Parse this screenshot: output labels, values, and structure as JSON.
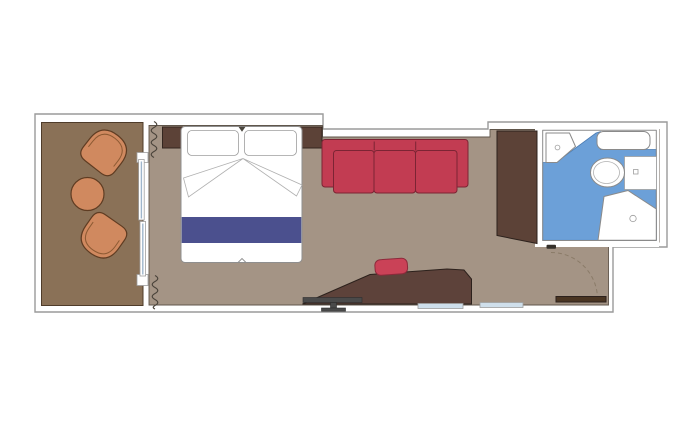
{
  "page": {
    "title": "Cruise ship cabin floor plan",
    "type": "floor-plan"
  },
  "colors": {
    "background": "#ffffff",
    "wall_fill": "#ffffff",
    "floor_cabin": "#a49485",
    "floor_balcony": "#8a7157",
    "wood_dark": "#5c4237",
    "desk_wood": "#5d423a",
    "sofa_red": "#c23c52",
    "stool_red": "#ca4257",
    "bed_white": "#ffffff",
    "runner_navy": "#4b508e",
    "chair_orange": "#d0895f",
    "chair_line": "#8d5a33",
    "bath_floor_blue": "#6ca0d8",
    "fixture_white": "#ffffff",
    "tv_gray": "#4a4a4a",
    "mirror_strip": "#cfdfeb",
    "door_wood": "#4a3522",
    "door_mark": "#35302a",
    "notch_dark": "#4a463e"
  },
  "rooms": [
    {
      "name": "balcony"
    },
    {
      "name": "sleeping-area"
    },
    {
      "name": "living-area"
    },
    {
      "name": "bathroom"
    },
    {
      "name": "entryway"
    }
  ],
  "furniture": [
    {
      "name": "balcony-armchair",
      "count": 2
    },
    {
      "name": "balcony-table",
      "count": 1
    },
    {
      "name": "double-bed",
      "pillows": 2
    },
    {
      "name": "bed-runner",
      "count": 1
    },
    {
      "name": "sofa",
      "cushions": 3
    },
    {
      "name": "wardrobe",
      "count": 1
    },
    {
      "name": "desk",
      "count": 1
    },
    {
      "name": "stool",
      "count": 1
    },
    {
      "name": "tv-stand",
      "count": 1
    },
    {
      "name": "washbasin",
      "count": 1
    },
    {
      "name": "vanity-shelf",
      "count": 1
    },
    {
      "name": "toilet",
      "count": 1
    },
    {
      "name": "shower",
      "count": 1
    },
    {
      "name": "sliding-balcony-door",
      "panels": 2
    },
    {
      "name": "curtain",
      "count": 2
    },
    {
      "name": "entry-door",
      "count": 1
    }
  ]
}
